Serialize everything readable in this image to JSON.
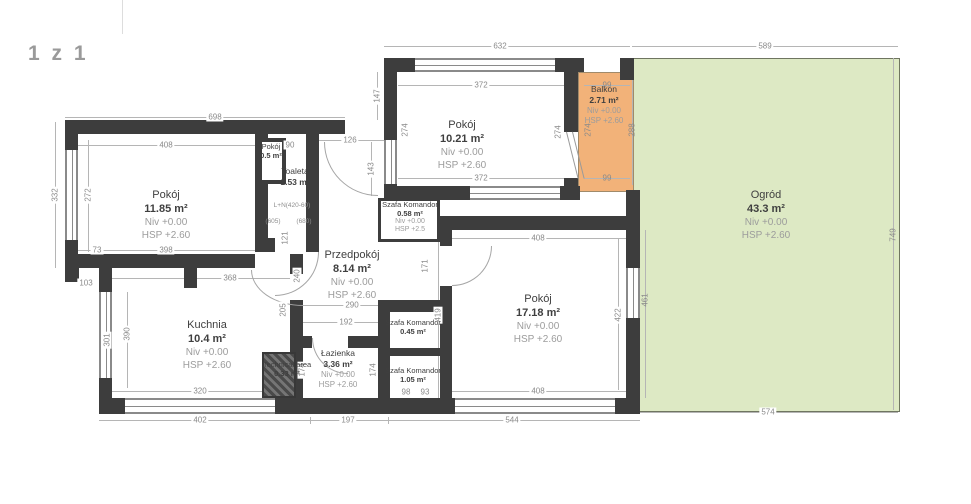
{
  "page": {
    "counter": "1 z 1"
  },
  "colors": {
    "wall": "#3d3d3d",
    "garden_fill": "#dde9c4",
    "balcony_fill": "#f2b279",
    "dim_text": "#8a8a8a"
  },
  "rooms": {
    "pokoj1": {
      "name": "Pokój",
      "area": "11.85 m²",
      "niv": "Niv +0.00",
      "hsp": "HSP +2.60"
    },
    "pokoj2": {
      "name": "Pokój",
      "area": "10.21 m²",
      "niv": "Niv +0.00",
      "hsp": "HSP +2.60"
    },
    "balkon": {
      "name": "Balkon",
      "area": "2.71 m²",
      "niv": "Niv +0.00",
      "hsp": "HSP +2.60"
    },
    "ogrod": {
      "name": "Ogród",
      "area": "43.3 m²",
      "niv": "Niv +0.00",
      "hsp": "HSP +2.60"
    },
    "pokoj_maly": {
      "name": "Pokój",
      "area": "0.5 m²"
    },
    "toaleta": {
      "name": "Toaleta",
      "area": "1.53 m²"
    },
    "przedpokoj": {
      "name": "Przedpokój",
      "area": "8.14 m²",
      "niv": "Niv +0.00",
      "hsp": "HSP +2.60"
    },
    "szafa1": {
      "name": "Szafa Komandor",
      "area": "0.58 m²",
      "niv": "Niv +0.00",
      "hsp": "HSP +2.5"
    },
    "kuchnia": {
      "name": "Kuchnia",
      "area": "10.4 m²",
      "niv": "Niv +0.00",
      "hsp": "HSP +2.60"
    },
    "technical": {
      "name": "Technical area",
      "area": "0.33 m²"
    },
    "lazienka": {
      "name": "Łazienka",
      "area": "3.36 m²",
      "niv": "Niv +0.00",
      "hsp": "HSP +2.60"
    },
    "szafa2": {
      "name": "Szafa Komandor",
      "area": "0.45 m²"
    },
    "szafa3": {
      "name": "Szafa Komandor",
      "area": "1.05 m²"
    },
    "pokoj3": {
      "name": "Pokój",
      "area": "17.18 m²",
      "niv": "Niv +0.00",
      "hsp": "HSP +2.60"
    }
  },
  "dims": {
    "outer_left_top": "698",
    "top_mid": "632",
    "garden_top": "589",
    "garden_right": "749",
    "garden_bottom": "574",
    "garden_left_inner": "461",
    "room1_top": "408",
    "toaleta_top": "90",
    "entry_top": "126",
    "entry_h": "147",
    "entry_side": "143",
    "room2_top": "372",
    "room2_bottom": "372",
    "balkon_top": "99",
    "balkon_bottom": "99",
    "room2_left": "274",
    "room2_door": "274",
    "balkon_side": "274",
    "balkon_garden": "288",
    "room1_left_outer": "332",
    "room1_left_inner": "272",
    "room1_bottom": "398",
    "room1_corner": "73",
    "kitchen_top": "368",
    "offset_left": "103",
    "kitchen_left": "301",
    "kitchen_inner": "390",
    "kitchen_bottom": "320",
    "bottom_left": "402",
    "bottom_mid": "197",
    "bottom_right": "544",
    "przedpokoj_left": "240",
    "przedpokoj_mid": "205",
    "przedpokoj_bottom": "290",
    "przedpokoj_inner": "192",
    "toaleta_door": "121",
    "szafa1_side": "171",
    "room3_left": "419",
    "room3_top": "408",
    "room3_bottom": "408",
    "room3_right": "422",
    "lazienka_left": "174",
    "lazienka_right": "174",
    "szafa3_w": "98",
    "szafa3_w2": "93"
  },
  "annotations": {
    "a1": "L+N(420-60)",
    "a2": "(605)",
    "a3": "(680)"
  }
}
